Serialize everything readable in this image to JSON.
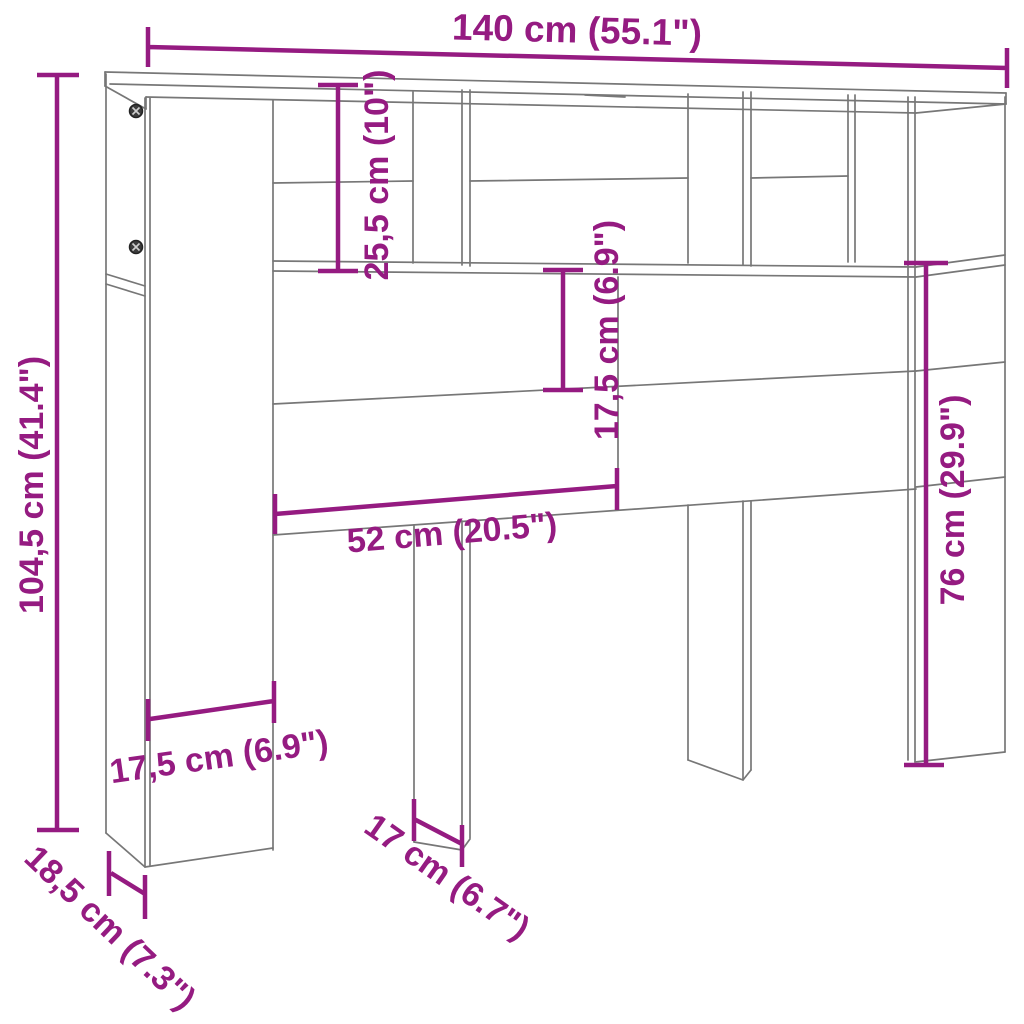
{
  "page": {
    "background": "#ffffff"
  },
  "diagram": {
    "type": "furniture-dimension-drawing",
    "colors": {
      "dimension": "#951b81",
      "outline": "#777777",
      "screw": "#3c3c3c",
      "background": "#ffffff"
    },
    "icons": {
      "cam_screw": "circle-with-cross"
    },
    "dims": {
      "width_total": "140 cm (55.1\")",
      "height_total": "104,5 cm (41.4\")",
      "top_section_height": "25,5 cm (10\")",
      "headboard_strip_height": "17,5 cm (6.9\")",
      "opening_width": "52 cm (20.5\")",
      "leg_clearance_height": "76 cm (29.9\")",
      "side_panel_width": "17,5 cm (6.9\")",
      "cabinet_depth": "18,5 cm (7.3\")",
      "leg_depth": "17 cm (6.7\")"
    }
  }
}
